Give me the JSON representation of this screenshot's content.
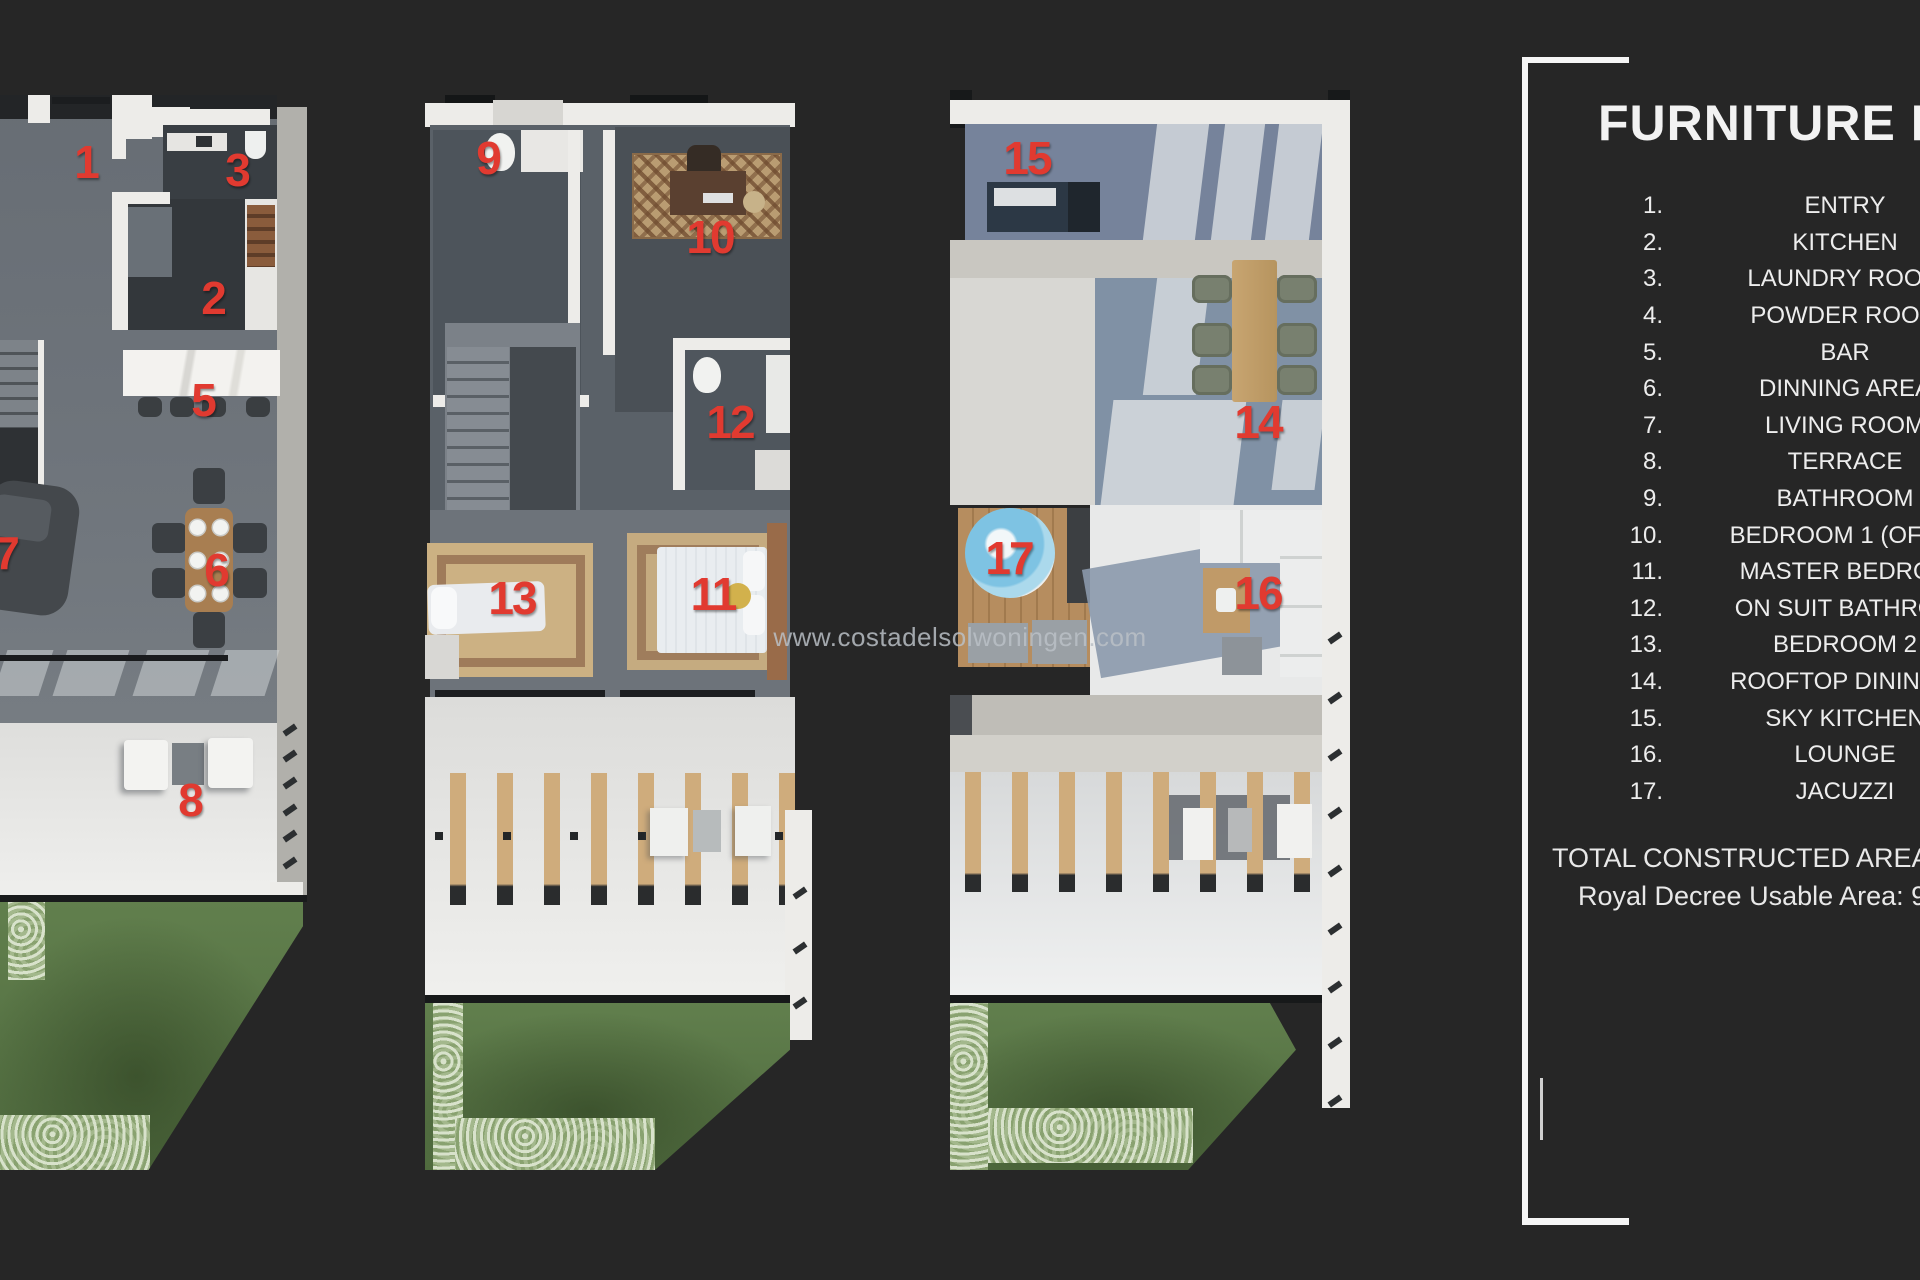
{
  "colors": {
    "background": "#262626",
    "marker_red": "#e13a30",
    "legend_text": "#ededed",
    "watermark_gray": "#bac0c5",
    "grass_green": "#5a7847",
    "rooftop_blue": "#8091a5"
  },
  "watermark": {
    "text": "www.costadelsolwoningen.com"
  },
  "legend": {
    "title": "FURNITURE PL",
    "items": [
      {
        "num": "1.",
        "label": "ENTRY"
      },
      {
        "num": "2.",
        "label": "KITCHEN"
      },
      {
        "num": "3.",
        "label": "LAUNDRY ROOM"
      },
      {
        "num": "4.",
        "label": "POWDER ROOM"
      },
      {
        "num": "5.",
        "label": "BAR"
      },
      {
        "num": "6.",
        "label": "DINNING AREA"
      },
      {
        "num": "7.",
        "label": "LIVING ROOM"
      },
      {
        "num": "8.",
        "label": "TERRACE"
      },
      {
        "num": "9.",
        "label": "BATHROOM"
      },
      {
        "num": "10.",
        "label": "BEDROOM 1 (OFFIC"
      },
      {
        "num": "11.",
        "label": "MASTER BEDROO"
      },
      {
        "num": "12.",
        "label": "ON SUIT BATHROO"
      },
      {
        "num": "13.",
        "label": "BEDROOM 2"
      },
      {
        "num": "14.",
        "label": "ROOFTOP DINING A"
      },
      {
        "num": "15.",
        "label": "SKY KITCHEN"
      },
      {
        "num": "16.",
        "label": "LOUNGE"
      },
      {
        "num": "17.",
        "label": "JACUZZI"
      }
    ],
    "footer_line1": "TOTAL CONSTRUCTED AREA: 1",
    "footer_line2": "Royal Decree Usable Area: 9"
  },
  "markers": {
    "m1": "1",
    "m2": "2",
    "m3": "3",
    "m5": "5",
    "m6": "6",
    "m7": "7",
    "m8": "8",
    "m9": "9",
    "m10": "10",
    "m11": "11",
    "m12": "12",
    "m13": "13",
    "m14": "14",
    "m15": "15",
    "m16": "16",
    "m17": "17"
  }
}
